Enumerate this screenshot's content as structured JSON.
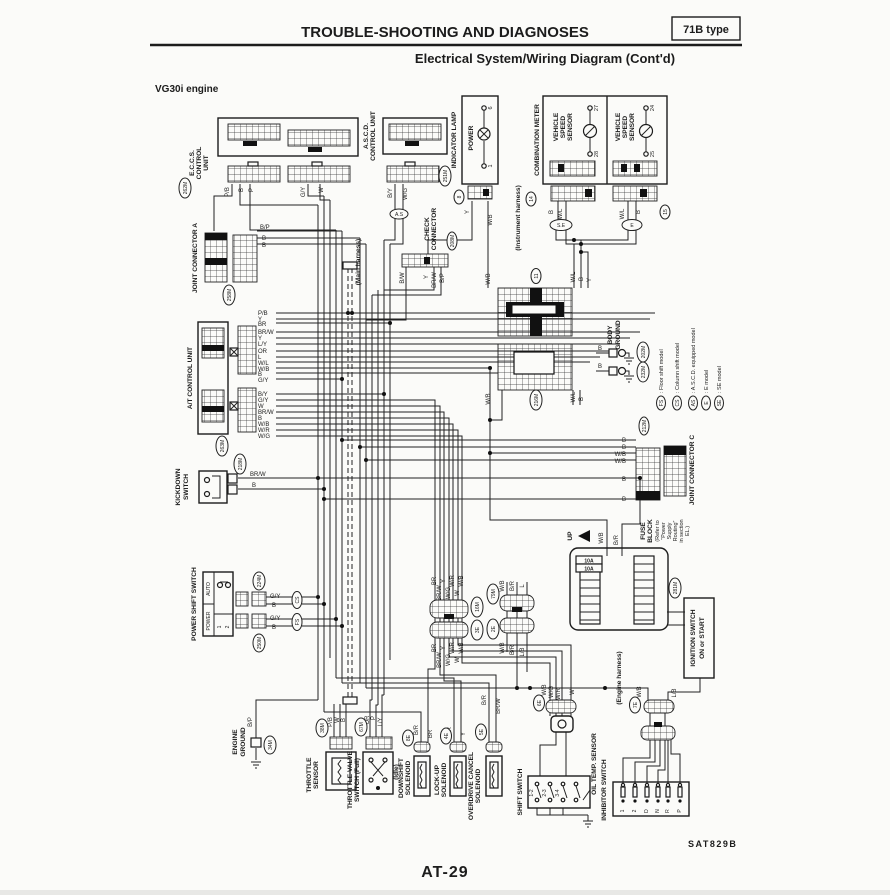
{
  "page": {
    "title": "TROUBLE-SHOOTING AND DIAGNOSES",
    "badge": "71B type",
    "subtitle": "Electrical System/Wiring Diagram (Cont'd)",
    "engine": "VG30i engine",
    "figure_code": "SAT829B",
    "page_number": "AT-29"
  },
  "wires": {
    "PB": "P/B",
    "B": "B",
    "P": "P",
    "GY": "G/Y",
    "W": "W",
    "BY": "B/Y",
    "WG": "W/G",
    "BP": "B/P",
    "BW": "B/W",
    "Y": "Y",
    "BRW": "BR/W",
    "BR": "BR",
    "LY": "L/Y",
    "OR": "OR",
    "L": "L",
    "WL": "W/L",
    "WB": "W/B",
    "WR": "W/R",
    "BR2": "B/R",
    "LB": "L/B"
  },
  "conn": {
    "m262": "262M",
    "m251": "251M",
    "m258": "258M",
    "m208": "208M",
    "m263": "263M",
    "m218": "218M",
    "m224": "224M",
    "m250": "250M",
    "m216": "216M",
    "m202": "202M",
    "m232": "232M",
    "m212": "212M",
    "m281": "281M",
    "m34": "34M",
    "m38": "38M",
    "m67": "67M",
    "m16": "16M",
    "m79": "79M",
    "e2": "2E",
    "e3": "3E",
    "e4": "4E",
    "e5": "5E",
    "e6": "6E",
    "e7": "7E",
    "e8": "8E",
    "c8": "8",
    "c11": "11",
    "c14": "14",
    "c15": "15"
  },
  "units": {
    "eccs": [
      "E.C.C.S.",
      "CONTROL",
      "UNIT"
    ],
    "ascd": [
      "A.S.C.D.",
      "CONTROL UNIT"
    ],
    "indicator": "INDICATOR LAMP",
    "power": "POWER",
    "combo": "COMBINATION METER",
    "vss": [
      "VEHICLE",
      "SPEED",
      "SENSOR"
    ],
    "jca": "JOINT CONNECTOR A",
    "jcc": "JOINT CONNECTOR C",
    "check": [
      "CHECK",
      "CONNECTOR"
    ],
    "atcu": "A/T CONTROL UNIT",
    "kickdown": [
      "KICKDOWN",
      "SWITCH"
    ],
    "pss": "POWER SHIFT SWITCH",
    "auto": "AUTO",
    "pwr": "POWER",
    "bg": [
      "BODY",
      "GROUND"
    ],
    "fuse": [
      "FUSE",
      "BLOCK",
      "(Refer to",
      "“Power",
      "Supply",
      "Routing”",
      "in section",
      "EL.)"
    ],
    "amp": "10A",
    "up": "UP",
    "ign": [
      "IGNITION SWITCH",
      "ON or START"
    ],
    "eg": [
      "ENGINE",
      "GROUND"
    ],
    "ts": [
      "THROTTLE",
      "SENSOR"
    ],
    "tvs": [
      "THROTTLE VALVE",
      "SWITCH (Full)"
    ],
    "idle": "(Idle)",
    "ds": [
      "DOWNSHIFT",
      "SOLENOID"
    ],
    "lu": [
      "LOCK-UP",
      "SOLENOID"
    ],
    "odc": [
      "OVERDRIVE CANCEL",
      "SOLENOID"
    ],
    "ss": "SHIFT SWITCH",
    "ots": "OIL TEMP. SENSOR",
    "inh": "INHIBITOR SWITCH"
  },
  "pins": {
    "p1": "1",
    "p2": "2",
    "p6": "6",
    "p24": "24",
    "p25": "25",
    "p27": "27",
    "p28": "28"
  },
  "gears": [
    "1-2",
    "2-3",
    "3-4"
  ],
  "inhibitor_terminals": [
    "1",
    "2",
    "D",
    "N",
    "R",
    "P"
  ],
  "models": {
    "se": "S.E",
    "e": "E",
    "as": "A.S",
    "cs": "CS",
    "fs": "FS"
  },
  "legend": [
    {
      "key": "FS",
      "text": ": Floor shift model"
    },
    {
      "key": "CS",
      "text": ": Column shift model"
    },
    {
      "key": "AS",
      "text": ": A.S.C.D. equipped model"
    },
    {
      "key": "E",
      "text": ": E model"
    },
    {
      "key": "SE",
      "text": ": SE model"
    }
  ],
  "harness": {
    "main": "(Main harness)",
    "instrument": "(Instrument harness)",
    "engine": "(Engine harness)"
  }
}
